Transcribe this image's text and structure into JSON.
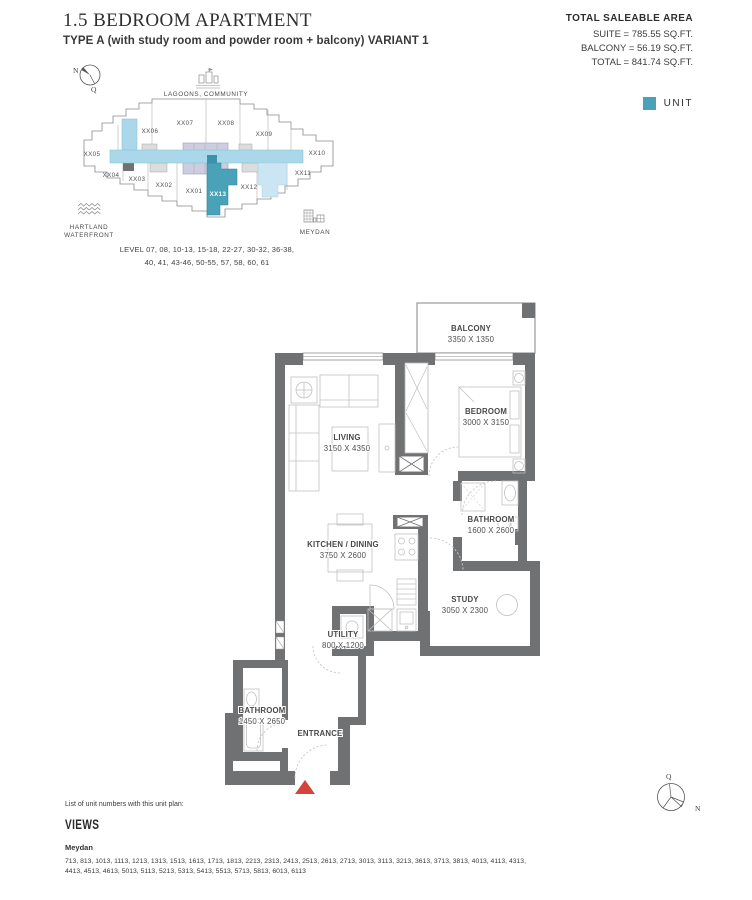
{
  "header": {
    "title": "1.5 BEDROOM APARTMENT",
    "subtitle": "TYPE A (with study room and powder room + balcony) VARIANT 1"
  },
  "area_summary": {
    "heading": "TOTAL SALEABLE AREA",
    "suite": "SUITE = 785.55 SQ.FT.",
    "balcony": "BALCONY = 56.19 SQ.FT.",
    "total": "TOTAL = 841.74 SQ.FT."
  },
  "legend": {
    "unit_label": "UNIT",
    "unit_color": "#49a2b8"
  },
  "site_plan": {
    "compass": {
      "n": "N",
      "q": "Q"
    },
    "landmark_top": "LAGOONS, COMMUNITY",
    "landmark_left_line1": "HARTLAND",
    "landmark_left_line2": "WATERFRONT",
    "landmark_right": "MEYDAN",
    "levels_line1": "LEVEL 07, 08, 10-13, 15-18, 22-27, 30-32, 36-38,",
    "levels_line2": "40, 41, 43-46, 50-55, 57, 58, 60, 61",
    "highlighted_unit": "XX13",
    "units": {
      "u01": "XX01",
      "u02": "XX02",
      "u03": "XX03",
      "u04": "XX04",
      "u05": "XX05",
      "u06": "XX06",
      "u07": "XX07",
      "u08": "XX08",
      "u09": "XX09",
      "u10": "XX10",
      "u11": "XX11",
      "u12": "XX12",
      "u13": "XX13"
    },
    "colors": {
      "corridor": "#aad8ea",
      "core": "#cdcde0",
      "unit": "#49a2b8",
      "unit_dark": "#3a93a9",
      "adjacent": "#cbe5f2",
      "wall": "#707173"
    }
  },
  "floor_plan": {
    "rooms": [
      {
        "name": "BALCONY",
        "dims": "3350 X 1350"
      },
      {
        "name": "BEDROOM",
        "dims": "3000 X 3150"
      },
      {
        "name": "LIVING",
        "dims": "3150 X 4350"
      },
      {
        "name": "BATHROOM",
        "dims": "1600 X 2600"
      },
      {
        "name": "KITCHEN / DINING",
        "dims": "3750 X 2600"
      },
      {
        "name": "STUDY",
        "dims": "3050 X 2300"
      },
      {
        "name": "UTILITY",
        "dims": "800 X 1200"
      },
      {
        "name": "BATHROOM",
        "dims": "1450 X 2650"
      }
    ],
    "entrance_label": "ENTRANCE",
    "marker_color": "#d4433c"
  },
  "footer": {
    "list_note": "List of unit numbers with this unit plan:",
    "views_heading": "VIEWS",
    "view_name": "Meydan",
    "numbers_line1": "713, 813, 1013, 1113, 1213, 1313, 1513, 1613, 1713, 1813, 2213, 2313, 2413, 2513, 2613, 2713, 3013, 3113, 3213, 3613, 3713, 3813, 4013, 4113, 4313,",
    "numbers_line2": "4413, 4513, 4613, 5013, 5113, 5213, 5313, 5413, 5513, 5713, 5813, 6013, 6113"
  },
  "compass_bottom": {
    "q": "Q",
    "n": "N"
  }
}
